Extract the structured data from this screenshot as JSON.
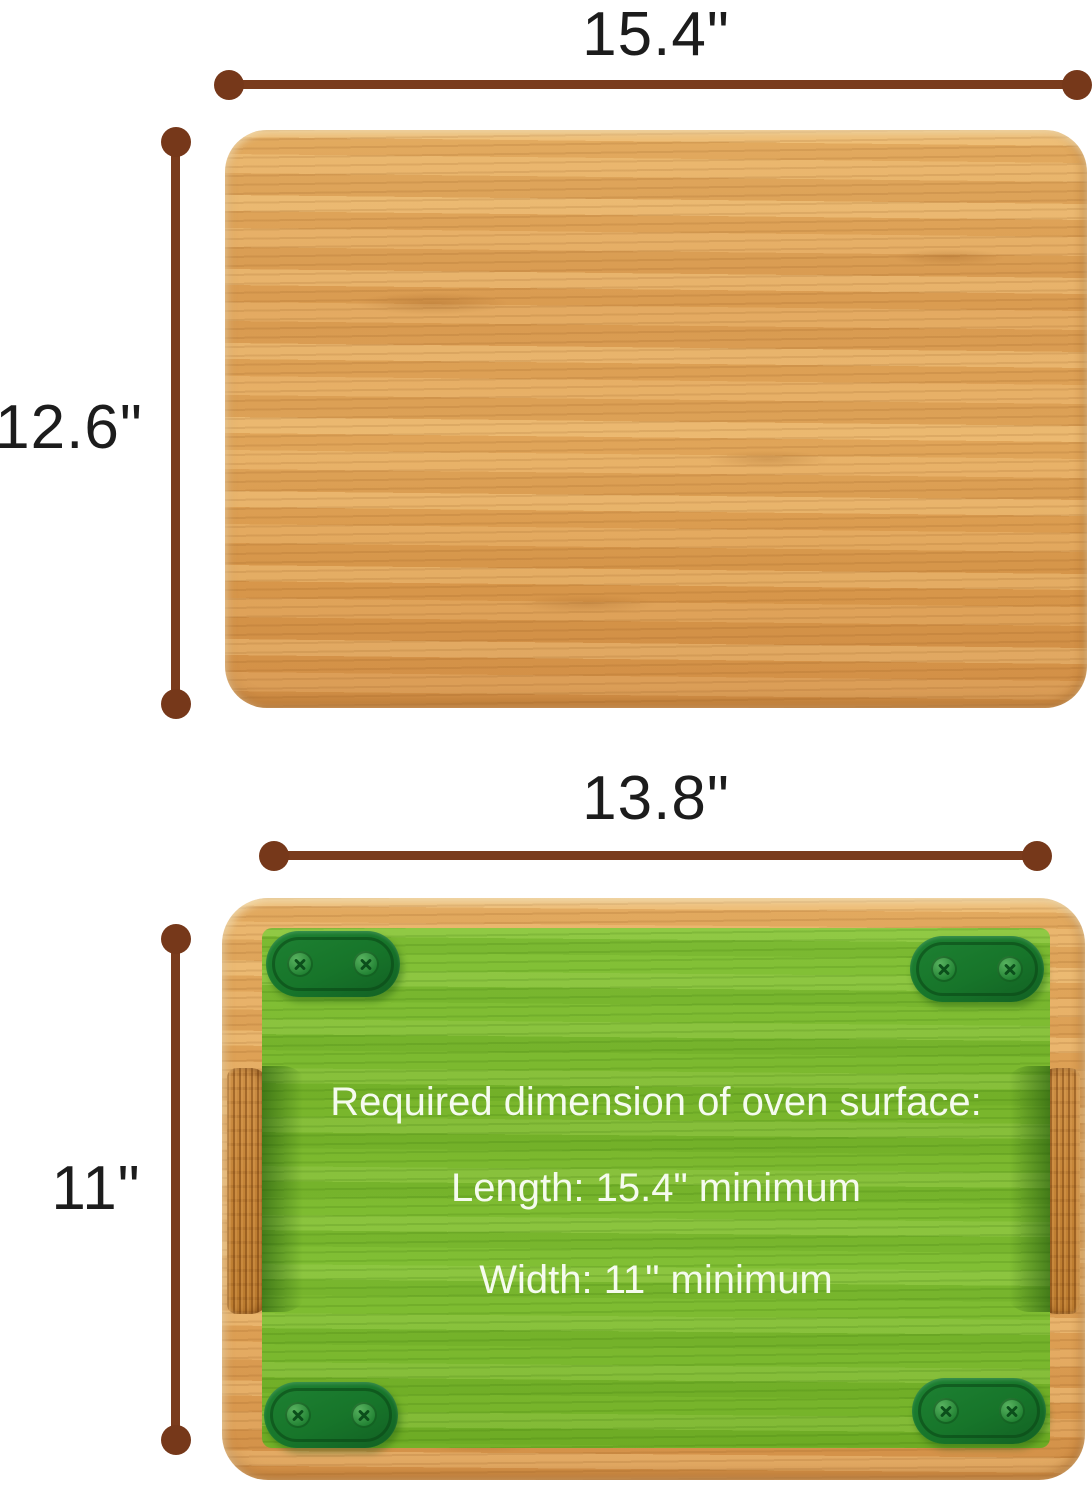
{
  "dimensions": {
    "board_top_width": "15.4\"",
    "board_top_height": "12.6\"",
    "board_bottom_width": "13.8\"",
    "board_bottom_height": "11\""
  },
  "overlay": {
    "title": "Required dimension of oven surface:",
    "length": "Length: 15.4\" minimum",
    "width": "Width: 11\" minimum"
  },
  "colors": {
    "dimension_line": "#7a3b1c",
    "board_wood": "#e0a256",
    "handle_wood": "#c48336",
    "overlay_green": "#79b62c",
    "pad_green": "#17752a",
    "label_text": "#1c1c1c",
    "overlay_text": "#f5fbee"
  }
}
